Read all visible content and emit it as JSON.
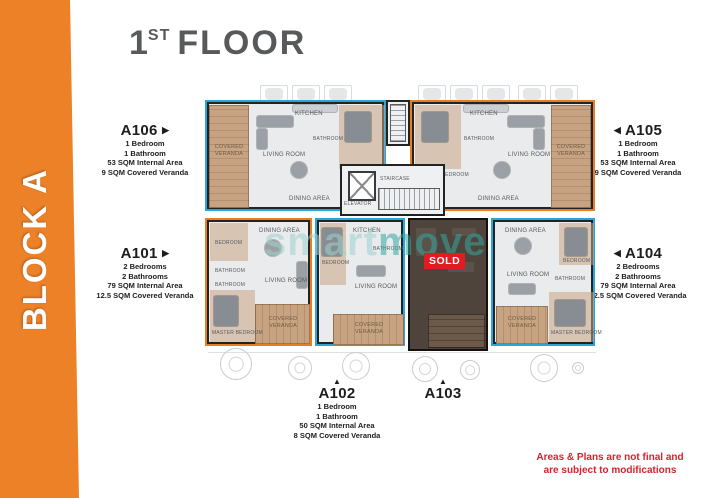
{
  "banner": {
    "text": "BLOCK A",
    "color": "#EC8128"
  },
  "title": {
    "number": "1",
    "ordinal": "ST",
    "word": "FLOOR"
  },
  "watermark": {
    "part1": "smart",
    "part2": "move"
  },
  "sold": {
    "label": "SOLD",
    "color": "#E21B22"
  },
  "disclaimer": {
    "line1": "Areas & Plans are not final and",
    "line2": "are subject to modifications"
  },
  "colors": {
    "blue_outline": "#2AA5DB",
    "orange_outline": "#E87E22",
    "veranda_wood": "#C8A382"
  },
  "units": [
    {
      "name": "A106",
      "arrow": "▶",
      "details": [
        "1 Bedroom",
        "1 Bathroom",
        "53 SQM Internal Area",
        "9 SQM Covered Veranda"
      ]
    },
    {
      "name": "A101",
      "arrow": "▶",
      "details": [
        "2 Bedrooms",
        "2 Bathrooms",
        "79 SQM Internal Area",
        "12.5 SQM Covered Veranda"
      ]
    },
    {
      "name": "A105",
      "arrow": "◀",
      "details": [
        "1 Bedroom",
        "1 Bathroom",
        "53 SQM Internal Area",
        "9 SQM Covered Veranda"
      ]
    },
    {
      "name": "A104",
      "arrow": "◀",
      "details": [
        "2 Bedrooms",
        "2 Bathrooms",
        "79 SQM Internal Area",
        "12.5 SQM Covered Veranda"
      ]
    },
    {
      "name": "A102",
      "arrow": "▲",
      "details": [
        "1 Bedroom",
        "1 Bathroom",
        "50 SQM Internal Area",
        "8 SQM Covered Veranda"
      ]
    },
    {
      "name": "A103",
      "arrow": "▲",
      "details": []
    }
  ],
  "rooms": {
    "living_room": "LIVING ROOM",
    "kitchen": "KITCHEN",
    "dining_area": "DINING AREA",
    "master_bedroom": "MASTER BEDROOM",
    "bedroom": "BEDROOM",
    "bathroom": "BATHROOM",
    "covered_veranda": "COVERED VERANDA",
    "elevator": "ELEVATOR",
    "staircase": "STAIRCASE"
  }
}
